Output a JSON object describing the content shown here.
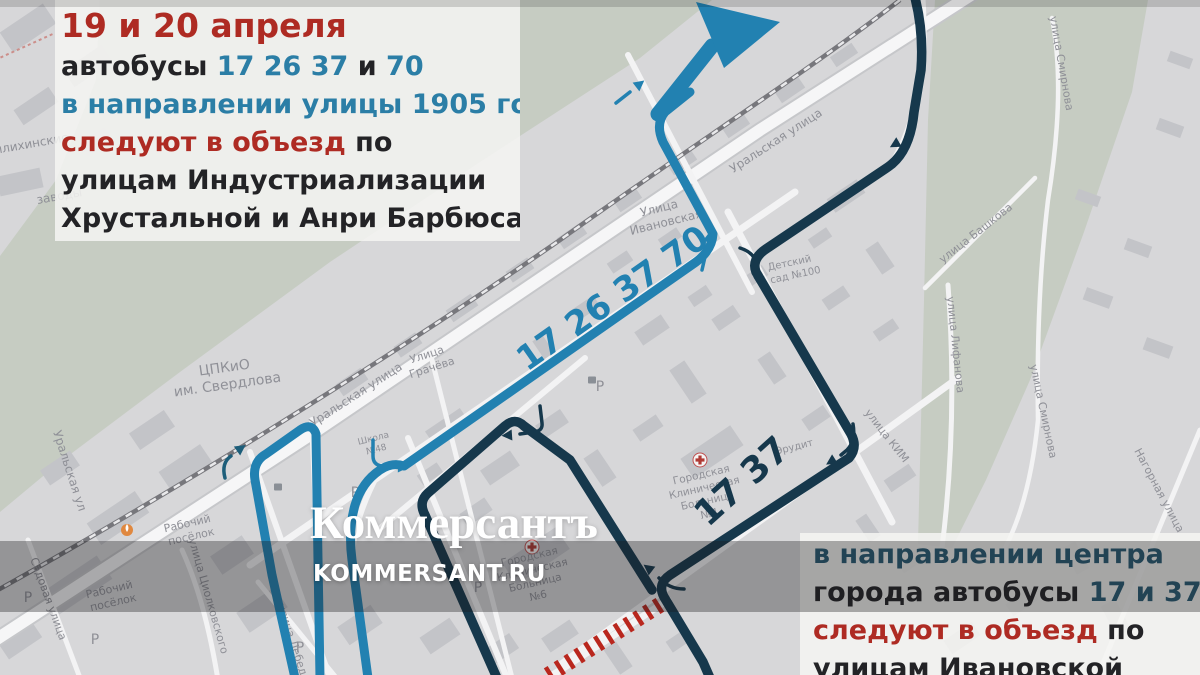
{
  "brand": {
    "logo": "Коммерсантъ",
    "site": "KOMMERSANT.RU"
  },
  "overlay_top": {
    "lines": [
      {
        "big": true,
        "segments": [
          {
            "t": "19 и 20 апреля",
            "c": "red"
          }
        ]
      },
      {
        "big": false,
        "segments": [
          {
            "t": "автобусы ",
            "c": "dark"
          },
          {
            "t": "17 26 37",
            "c": "blue"
          },
          {
            "t": " и ",
            "c": "dark"
          },
          {
            "t": "70",
            "c": "blue"
          }
        ]
      },
      {
        "big": false,
        "segments": [
          {
            "t": "в направлении улицы 1905 года",
            "c": "blue"
          }
        ]
      },
      {
        "big": false,
        "segments": [
          {
            "t": "следуют в объезд",
            "c": "red"
          },
          {
            "t": " по",
            "c": "dark"
          }
        ]
      },
      {
        "big": false,
        "segments": [
          {
            "t": "улицам Индустриализации",
            "c": "dark"
          }
        ]
      },
      {
        "big": false,
        "segments": [
          {
            "t": "Хрустальной и Анри Барбюса",
            "c": "dark"
          }
        ]
      }
    ]
  },
  "overlay_bottom": {
    "lines": [
      {
        "big": false,
        "segments": [
          {
            "t": "в направлении центра",
            "c": "teal"
          }
        ]
      },
      {
        "big": false,
        "segments": [
          {
            "t": "города автобусы ",
            "c": "dark"
          },
          {
            "t": "17 и 37",
            "c": "teal"
          }
        ]
      },
      {
        "big": false,
        "segments": [
          {
            "t": "следуют в объезд",
            "c": "red"
          },
          {
            "t": " по",
            "c": "dark"
          }
        ]
      },
      {
        "big": false,
        "segments": [
          {
            "t": "улицам Ивановской",
            "c": "dark"
          }
        ]
      }
    ]
  },
  "map": {
    "route_labels": {
      "light": "17 26 37 70",
      "dark": "17 37"
    },
    "colors": {
      "route_light": "#2281b1",
      "route_dark": "#16384c",
      "turn_arrow_teal": "#1d5e7a",
      "closed_road": "#b9271e",
      "text_red": "#ae2b23",
      "text_blue": "#2b7ea6",
      "text_teal": "#275a72"
    },
    "street_labels": [
      {
        "t": "ЦПКиО",
        "x": 225,
        "y": 372,
        "r": -8,
        "s": 14
      },
      {
        "t": "им. Свердлова",
        "x": 228,
        "y": 389,
        "r": -8,
        "s": 14
      },
      {
        "t": "Уральская улица",
        "x": 358,
        "y": 398,
        "r": -33,
        "s": 12
      },
      {
        "t": "Уральская улица",
        "x": 778,
        "y": 144,
        "r": -33,
        "s": 12
      },
      {
        "t": "Уральская ул",
        "x": 66,
        "y": 472,
        "r": 72,
        "s": 12
      },
      {
        "t": "Улица",
        "x": 428,
        "y": 358,
        "r": -18,
        "s": 11
      },
      {
        "t": "Грачёва",
        "x": 433,
        "y": 371,
        "r": -18,
        "s": 11
      },
      {
        "t": "Улица",
        "x": 660,
        "y": 212,
        "r": -14,
        "s": 12
      },
      {
        "t": "Ивановская",
        "x": 667,
        "y": 226,
        "r": -14,
        "s": 12
      },
      {
        "t": "Школа",
        "x": 374,
        "y": 441,
        "r": -14,
        "s": 9
      },
      {
        "t": "№48",
        "x": 377,
        "y": 452,
        "r": -14,
        "s": 9
      },
      {
        "t": "Детский",
        "x": 790,
        "y": 266,
        "r": -12,
        "s": 10
      },
      {
        "t": "сад №100",
        "x": 796,
        "y": 278,
        "r": -12,
        "s": 10
      },
      {
        "t": "Эрудит",
        "x": 795,
        "y": 450,
        "r": -14,
        "s": 10
      },
      {
        "t": "Городская",
        "x": 702,
        "y": 478,
        "r": -13,
        "s": 10.5
      },
      {
        "t": "Клиническая",
        "x": 705,
        "y": 491,
        "r": -13,
        "s": 10.5
      },
      {
        "t": "Больница",
        "x": 708,
        "y": 504,
        "r": -13,
        "s": 10.5
      },
      {
        "t": "№4",
        "x": 710,
        "y": 517,
        "r": -13,
        "s": 10.5
      },
      {
        "t": "Городская",
        "x": 530,
        "y": 560,
        "r": -13,
        "s": 10.5
      },
      {
        "t": "Клиническая",
        "x": 533,
        "y": 573,
        "r": -13,
        "s": 10.5
      },
      {
        "t": "Больница",
        "x": 536,
        "y": 586,
        "r": -13,
        "s": 10.5
      },
      {
        "t": "№6",
        "x": 539,
        "y": 599,
        "r": -13,
        "s": 10.5
      },
      {
        "t": "улица КИМ",
        "x": 884,
        "y": 438,
        "r": 52,
        "s": 11
      },
      {
        "t": "улица Лифанова",
        "x": 952,
        "y": 345,
        "r": 84,
        "s": 11
      },
      {
        "t": "улица Смирнова",
        "x": 1058,
        "y": 64,
        "r": 80,
        "s": 11
      },
      {
        "t": "улица Смирнова",
        "x": 1040,
        "y": 412,
        "r": 78,
        "s": 11
      },
      {
        "t": "улица Башкова",
        "x": 978,
        "y": 236,
        "r": -38,
        "s": 11
      },
      {
        "t": "Нагорная улица",
        "x": 1156,
        "y": 492,
        "r": 62,
        "s": 11
      },
      {
        "t": "Рабочий",
        "x": 188,
        "y": 527,
        "r": -13,
        "s": 11
      },
      {
        "t": "посёлок",
        "x": 192,
        "y": 540,
        "r": -13,
        "s": 11
      },
      {
        "t": "Рабочий",
        "x": 110,
        "y": 593,
        "r": -13,
        "s": 11
      },
      {
        "t": "посёлок",
        "x": 114,
        "y": 606,
        "r": -13,
        "s": 11
      },
      {
        "t": "улица Циолковского",
        "x": 205,
        "y": 597,
        "r": 74,
        "s": 11
      },
      {
        "t": "улица Лебедева",
        "x": 292,
        "y": 650,
        "r": 72,
        "s": 11
      },
      {
        "t": "Садовая улица",
        "x": 45,
        "y": 600,
        "r": 70,
        "s": 11
      },
      {
        "t": "отовилихинские",
        "x": 18,
        "y": 150,
        "r": -10,
        "s": 12
      },
      {
        "t": "заводы",
        "x": 60,
        "y": 200,
        "r": -10,
        "s": 12
      },
      {
        "t": "Р",
        "x": 355,
        "y": 497,
        "r": 0,
        "s": 14
      },
      {
        "t": "Р",
        "x": 478,
        "y": 592,
        "r": 0,
        "s": 14
      },
      {
        "t": "Р",
        "x": 300,
        "y": 652,
        "r": 0,
        "s": 14
      },
      {
        "t": "Р",
        "x": 600,
        "y": 391,
        "r": 0,
        "s": 14
      },
      {
        "t": "Р",
        "x": 28,
        "y": 602,
        "r": 0,
        "s": 14
      },
      {
        "t": "Р",
        "x": 95,
        "y": 644,
        "r": 0,
        "s": 14
      }
    ]
  }
}
